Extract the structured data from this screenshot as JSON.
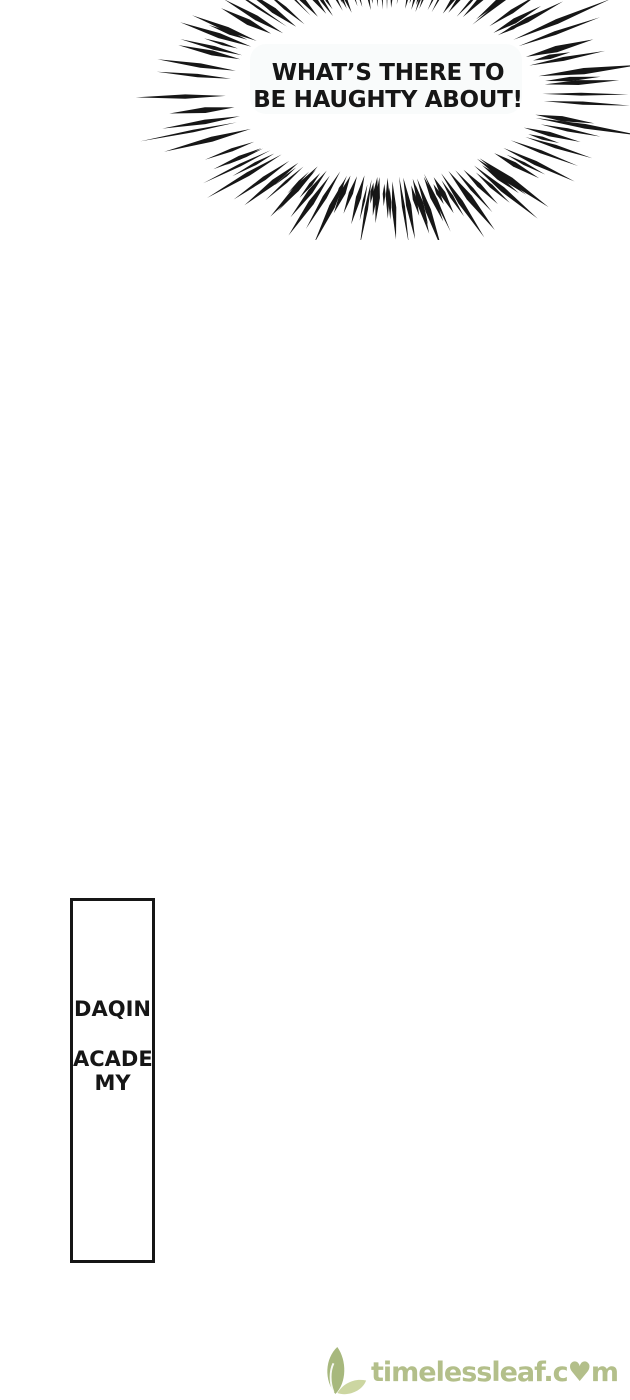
{
  "colors": {
    "page-bg": "#ffffff",
    "ink": "#161616",
    "bubble-tint": "#f6f9f9",
    "watermark-green": "#b3bf8a",
    "leaf-dark": "#a7b87d",
    "leaf-light": "#ccd6a1"
  },
  "speech_burst": {
    "line1": "WHAT’S THERE TO",
    "line2": "BE HAUGHTY ABOUT!"
  },
  "sign": {
    "line1": "DAQIN",
    "line2": "ACADE",
    "line3": "MY"
  },
  "watermark": {
    "text": "timelessleaf.com",
    "display": "timelessleaf.c♥m",
    "icon": "leaf-logo"
  }
}
